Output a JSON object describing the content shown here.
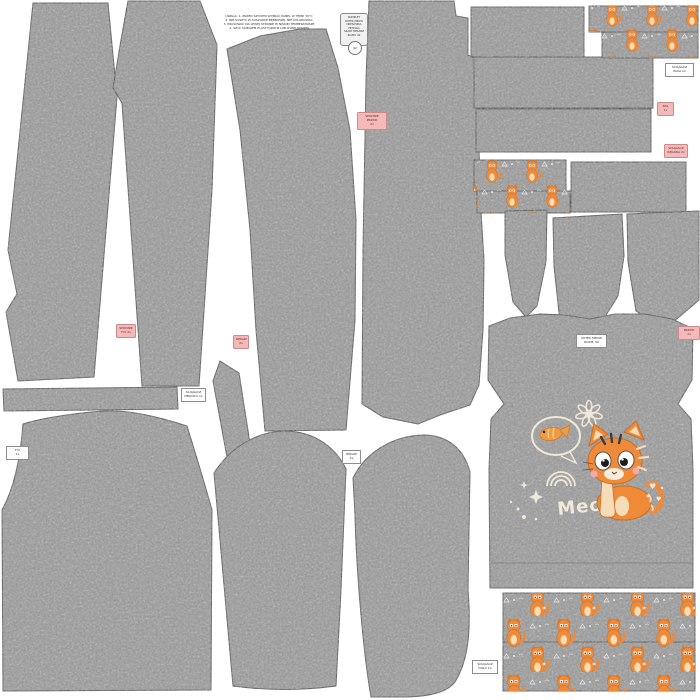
{
  "canvas": {
    "background": "#ffffff"
  },
  "colors": {
    "fabric_gray": "#9a9a9a",
    "fabric_outline": "#4a4a4a",
    "print_orange": "#ef8a38",
    "print_orange_dark": "#c96f25",
    "label_pink": "#f5b9b9",
    "label_white": "#fdfdfd",
    "doodle_cream": "#f0e8d8"
  },
  "header_note": {
    "text": "UWAGA: 1. PRZED SZYCIEM WYPRAĆ PANEL W TEMP. 30°C\n2. NIE SUSZYĆ W SUSZARCE BĘBNOWEJ, NIE CHLOROWAĆ\n3. PRASOWAĆ NA LEWEJ STRONIE W NISKIEJ TEMPERATURZE\n4. SZYĆ ŚCIEGIEM ELASTYCZNYM LUB OVERLOCKIEM"
  },
  "info_card": {
    "text": "KOMPLET\nKOTEK MEOW\nDRESÓWKA PĘTELKA\nSZARY MELANŻ\nROZM. 92",
    "stamp": "92"
  },
  "labels": {
    "pants_front": {
      "text": "SPODNIE\nPRZÓD\n2x"
    },
    "waistband": {
      "text": "PAS\n1x"
    },
    "sleeve_cuff": {
      "text": "ŚCIĄGACZ\nRĘKAWA 2x"
    },
    "pants_back": {
      "text": "SPODNIE\nTYŁ 2x"
    },
    "sleeve": {
      "text": "RĘKAW\n2x"
    },
    "front": {
      "text": "PRZÓD\n1x"
    },
    "waist_cuff": {
      "text": "ŚCIĄGACZ\nPASA 1x"
    },
    "neckband": {
      "text": "ŚCIĄGACZ\nDEKOLTU 1x"
    },
    "back": {
      "text": "TYŁ\n1x"
    },
    "sleeve2": {
      "text": "RĘKAW\n2x"
    },
    "hem_cuff": {
      "text": "ŚCIĄGACZ\nDOŁU 1x"
    },
    "shirt_size": {
      "text": "KOTEK MEOW\nROZM. 92"
    }
  },
  "shirt": {
    "meow": "Meow"
  }
}
